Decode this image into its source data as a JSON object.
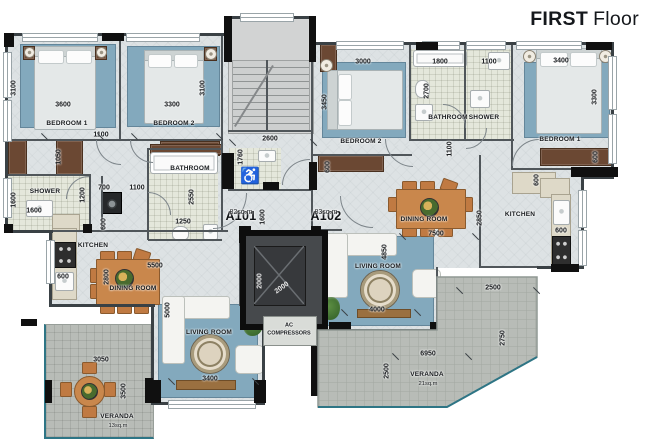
{
  "title": {
    "bold": "FIRST",
    "regular": "Floor"
  },
  "plan": {
    "units": [
      {
        "id": "A101",
        "area": "82sq.m",
        "x": 241,
        "y": 209
      },
      {
        "id": "A102",
        "area": "83sq.m",
        "x": 326,
        "y": 209
      }
    ],
    "core": {
      "wheelchair_icon": "♿",
      "ac_lines": [
        "AC",
        "COMPRESSORS"
      ],
      "ac_x": 289,
      "ac_y": 326
    },
    "rooms": [
      {
        "t": "BEDROOM 1",
        "x": 67,
        "y": 124
      },
      {
        "t": "BEDROOM 2",
        "x": 174,
        "y": 124
      },
      {
        "t": "SHOWER",
        "x": 45,
        "y": 192
      },
      {
        "t": "BATHROOM",
        "x": 190,
        "y": 169
      },
      {
        "t": "KITCHEN",
        "x": 93,
        "y": 246
      },
      {
        "t": "DINING ROOM",
        "x": 133,
        "y": 289
      },
      {
        "t": "LIVING ROOM",
        "x": 209,
        "y": 333
      },
      {
        "t": "VERANDA",
        "x": 117,
        "y": 417,
        "sub": "13sq.m"
      },
      {
        "t": "BEDROOM 2",
        "x": 361,
        "y": 142
      },
      {
        "t": "BATHROOM",
        "x": 448,
        "y": 118
      },
      {
        "t": "SHOWER",
        "x": 484,
        "y": 118
      },
      {
        "t": "BEDROOM 1",
        "x": 560,
        "y": 140
      },
      {
        "t": "DINING ROOM",
        "x": 424,
        "y": 220
      },
      {
        "t": "KITCHEN",
        "x": 520,
        "y": 215
      },
      {
        "t": "LIVING ROOM",
        "x": 378,
        "y": 267
      },
      {
        "t": "VERANDA",
        "x": 427,
        "y": 375,
        "sub": "21sq.m"
      }
    ],
    "dimensions": [
      {
        "t": "3100",
        "x": 14,
        "y": 88,
        "r": -90
      },
      {
        "t": "3600",
        "x": 63,
        "y": 105
      },
      {
        "t": "1100",
        "x": 101,
        "y": 135
      },
      {
        "t": "1050",
        "x": 59,
        "y": 157,
        "r": -90
      },
      {
        "t": "3300",
        "x": 172,
        "y": 105
      },
      {
        "t": "3100",
        "x": 203,
        "y": 88,
        "r": -90
      },
      {
        "t": "1600",
        "x": 14,
        "y": 200,
        "r": -90
      },
      {
        "t": "1600",
        "x": 34,
        "y": 211
      },
      {
        "t": "1200",
        "x": 83,
        "y": 195,
        "r": -90
      },
      {
        "t": "700",
        "x": 104,
        "y": 188
      },
      {
        "t": "1100",
        "x": 137,
        "y": 188
      },
      {
        "t": "600",
        "x": 104,
        "y": 224,
        "r": -90
      },
      {
        "t": "600",
        "x": 63,
        "y": 277
      },
      {
        "t": "2800",
        "x": 107,
        "y": 277,
        "r": -90
      },
      {
        "t": "5500",
        "x": 155,
        "y": 266
      },
      {
        "t": "2550",
        "x": 192,
        "y": 197,
        "r": -90
      },
      {
        "t": "1250",
        "x": 183,
        "y": 222
      },
      {
        "t": "5000",
        "x": 168,
        "y": 310,
        "r": -90
      },
      {
        "t": "3400",
        "x": 210,
        "y": 379
      },
      {
        "t": "3050",
        "x": 101,
        "y": 360
      },
      {
        "t": "3500",
        "x": 124,
        "y": 391,
        "r": -90
      },
      {
        "t": "2600",
        "x": 270,
        "y": 139
      },
      {
        "t": "1760",
        "x": 241,
        "y": 157,
        "r": -90
      },
      {
        "t": "1600",
        "x": 263,
        "y": 217,
        "r": -90
      },
      {
        "t": "2000",
        "x": 260,
        "y": 281,
        "r": -90,
        "w": true
      },
      {
        "t": "2000",
        "x": 282,
        "y": 288,
        "r": -35,
        "w": true
      },
      {
        "t": "3000",
        "x": 363,
        "y": 62
      },
      {
        "t": "3450",
        "x": 325,
        "y": 102,
        "r": -90
      },
      {
        "t": "1800",
        "x": 440,
        "y": 62
      },
      {
        "t": "2700",
        "x": 427,
        "y": 91,
        "r": -90
      },
      {
        "t": "1100",
        "x": 489,
        "y": 62
      },
      {
        "t": "1100",
        "x": 450,
        "y": 149,
        "r": -90
      },
      {
        "t": "600",
        "x": 328,
        "y": 167,
        "r": -90
      },
      {
        "t": "3400",
        "x": 561,
        "y": 61
      },
      {
        "t": "3300",
        "x": 595,
        "y": 97,
        "r": -90
      },
      {
        "t": "600",
        "x": 596,
        "y": 157,
        "r": -90
      },
      {
        "t": "600",
        "x": 537,
        "y": 180,
        "r": -90
      },
      {
        "t": "600",
        "x": 561,
        "y": 231
      },
      {
        "t": "7500",
        "x": 436,
        "y": 234
      },
      {
        "t": "4850",
        "x": 385,
        "y": 252,
        "r": -90
      },
      {
        "t": "2850",
        "x": 480,
        "y": 218,
        "r": -90
      },
      {
        "t": "4000",
        "x": 377,
        "y": 310
      },
      {
        "t": "2500",
        "x": 493,
        "y": 288
      },
      {
        "t": "2750",
        "x": 503,
        "y": 338,
        "r": -90
      },
      {
        "t": "6950",
        "x": 428,
        "y": 354
      },
      {
        "t": "2500",
        "x": 387,
        "y": 371,
        "r": -90
      }
    ],
    "colors": {
      "wall": "#101010",
      "floor": "#dde2e4",
      "carpet": "#83a9bd",
      "tile": "#e4e7db",
      "veranda": "#b8bcb7",
      "wood": "#c9874c",
      "dark_wood": "#6b4833",
      "rail_teal": "#2e7585",
      "title": "#15181c"
    }
  }
}
